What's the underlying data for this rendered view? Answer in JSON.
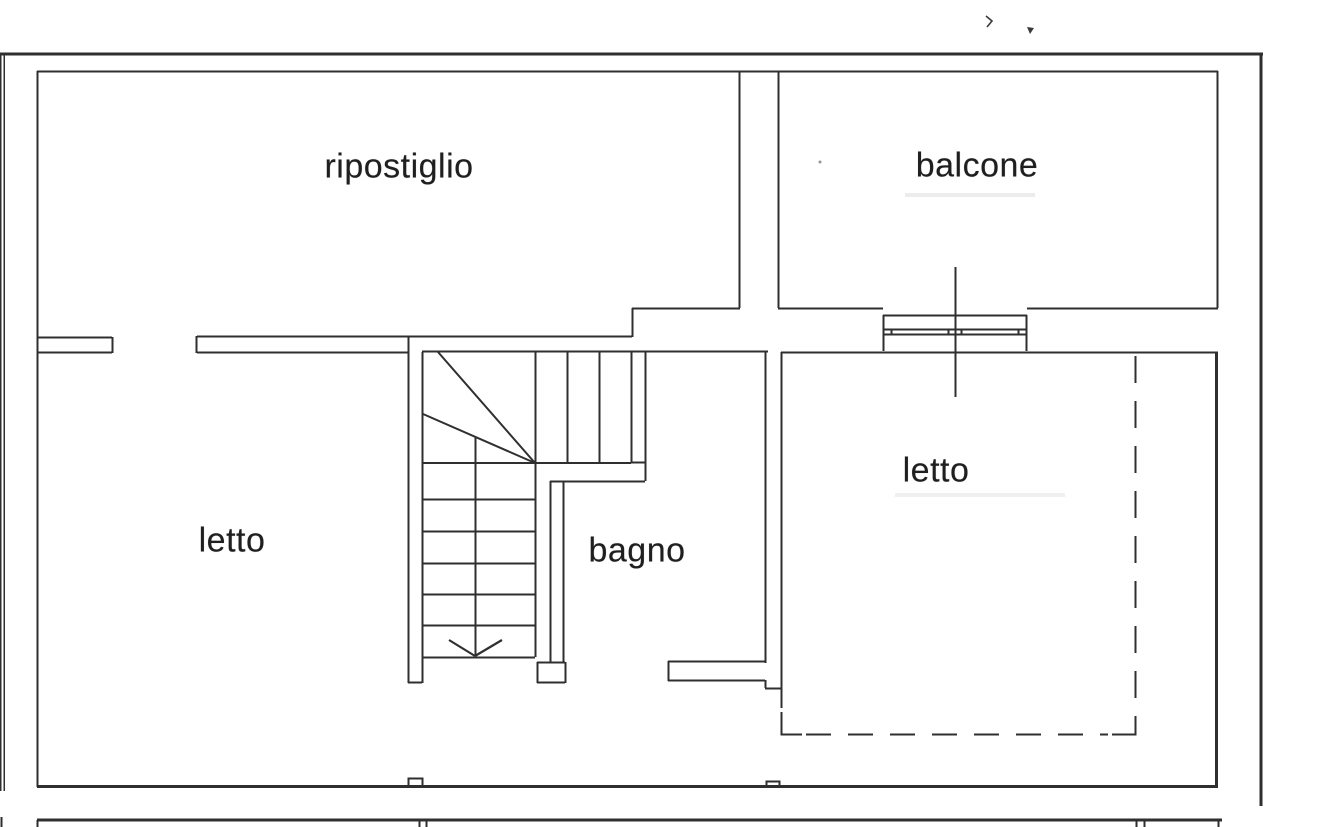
{
  "floorplan": {
    "rooms": [
      {
        "id": "ripostiglio",
        "label": "ripostiglio"
      },
      {
        "id": "balcone",
        "label": "balcone"
      },
      {
        "id": "letto-left",
        "label": "letto"
      },
      {
        "id": "bagno",
        "label": "bagno"
      },
      {
        "id": "letto-right",
        "label": "letto"
      }
    ],
    "symbols": [
      {
        "name": "stairs"
      },
      {
        "name": "stairs-direction-arrow"
      },
      {
        "name": "window-symbol"
      },
      {
        "name": "section-line"
      },
      {
        "name": "dashed-projection-outline"
      }
    ],
    "colors": {
      "background": "#ffffff",
      "line": "#2f2f2f",
      "text": "#1f1f1f"
    }
  }
}
